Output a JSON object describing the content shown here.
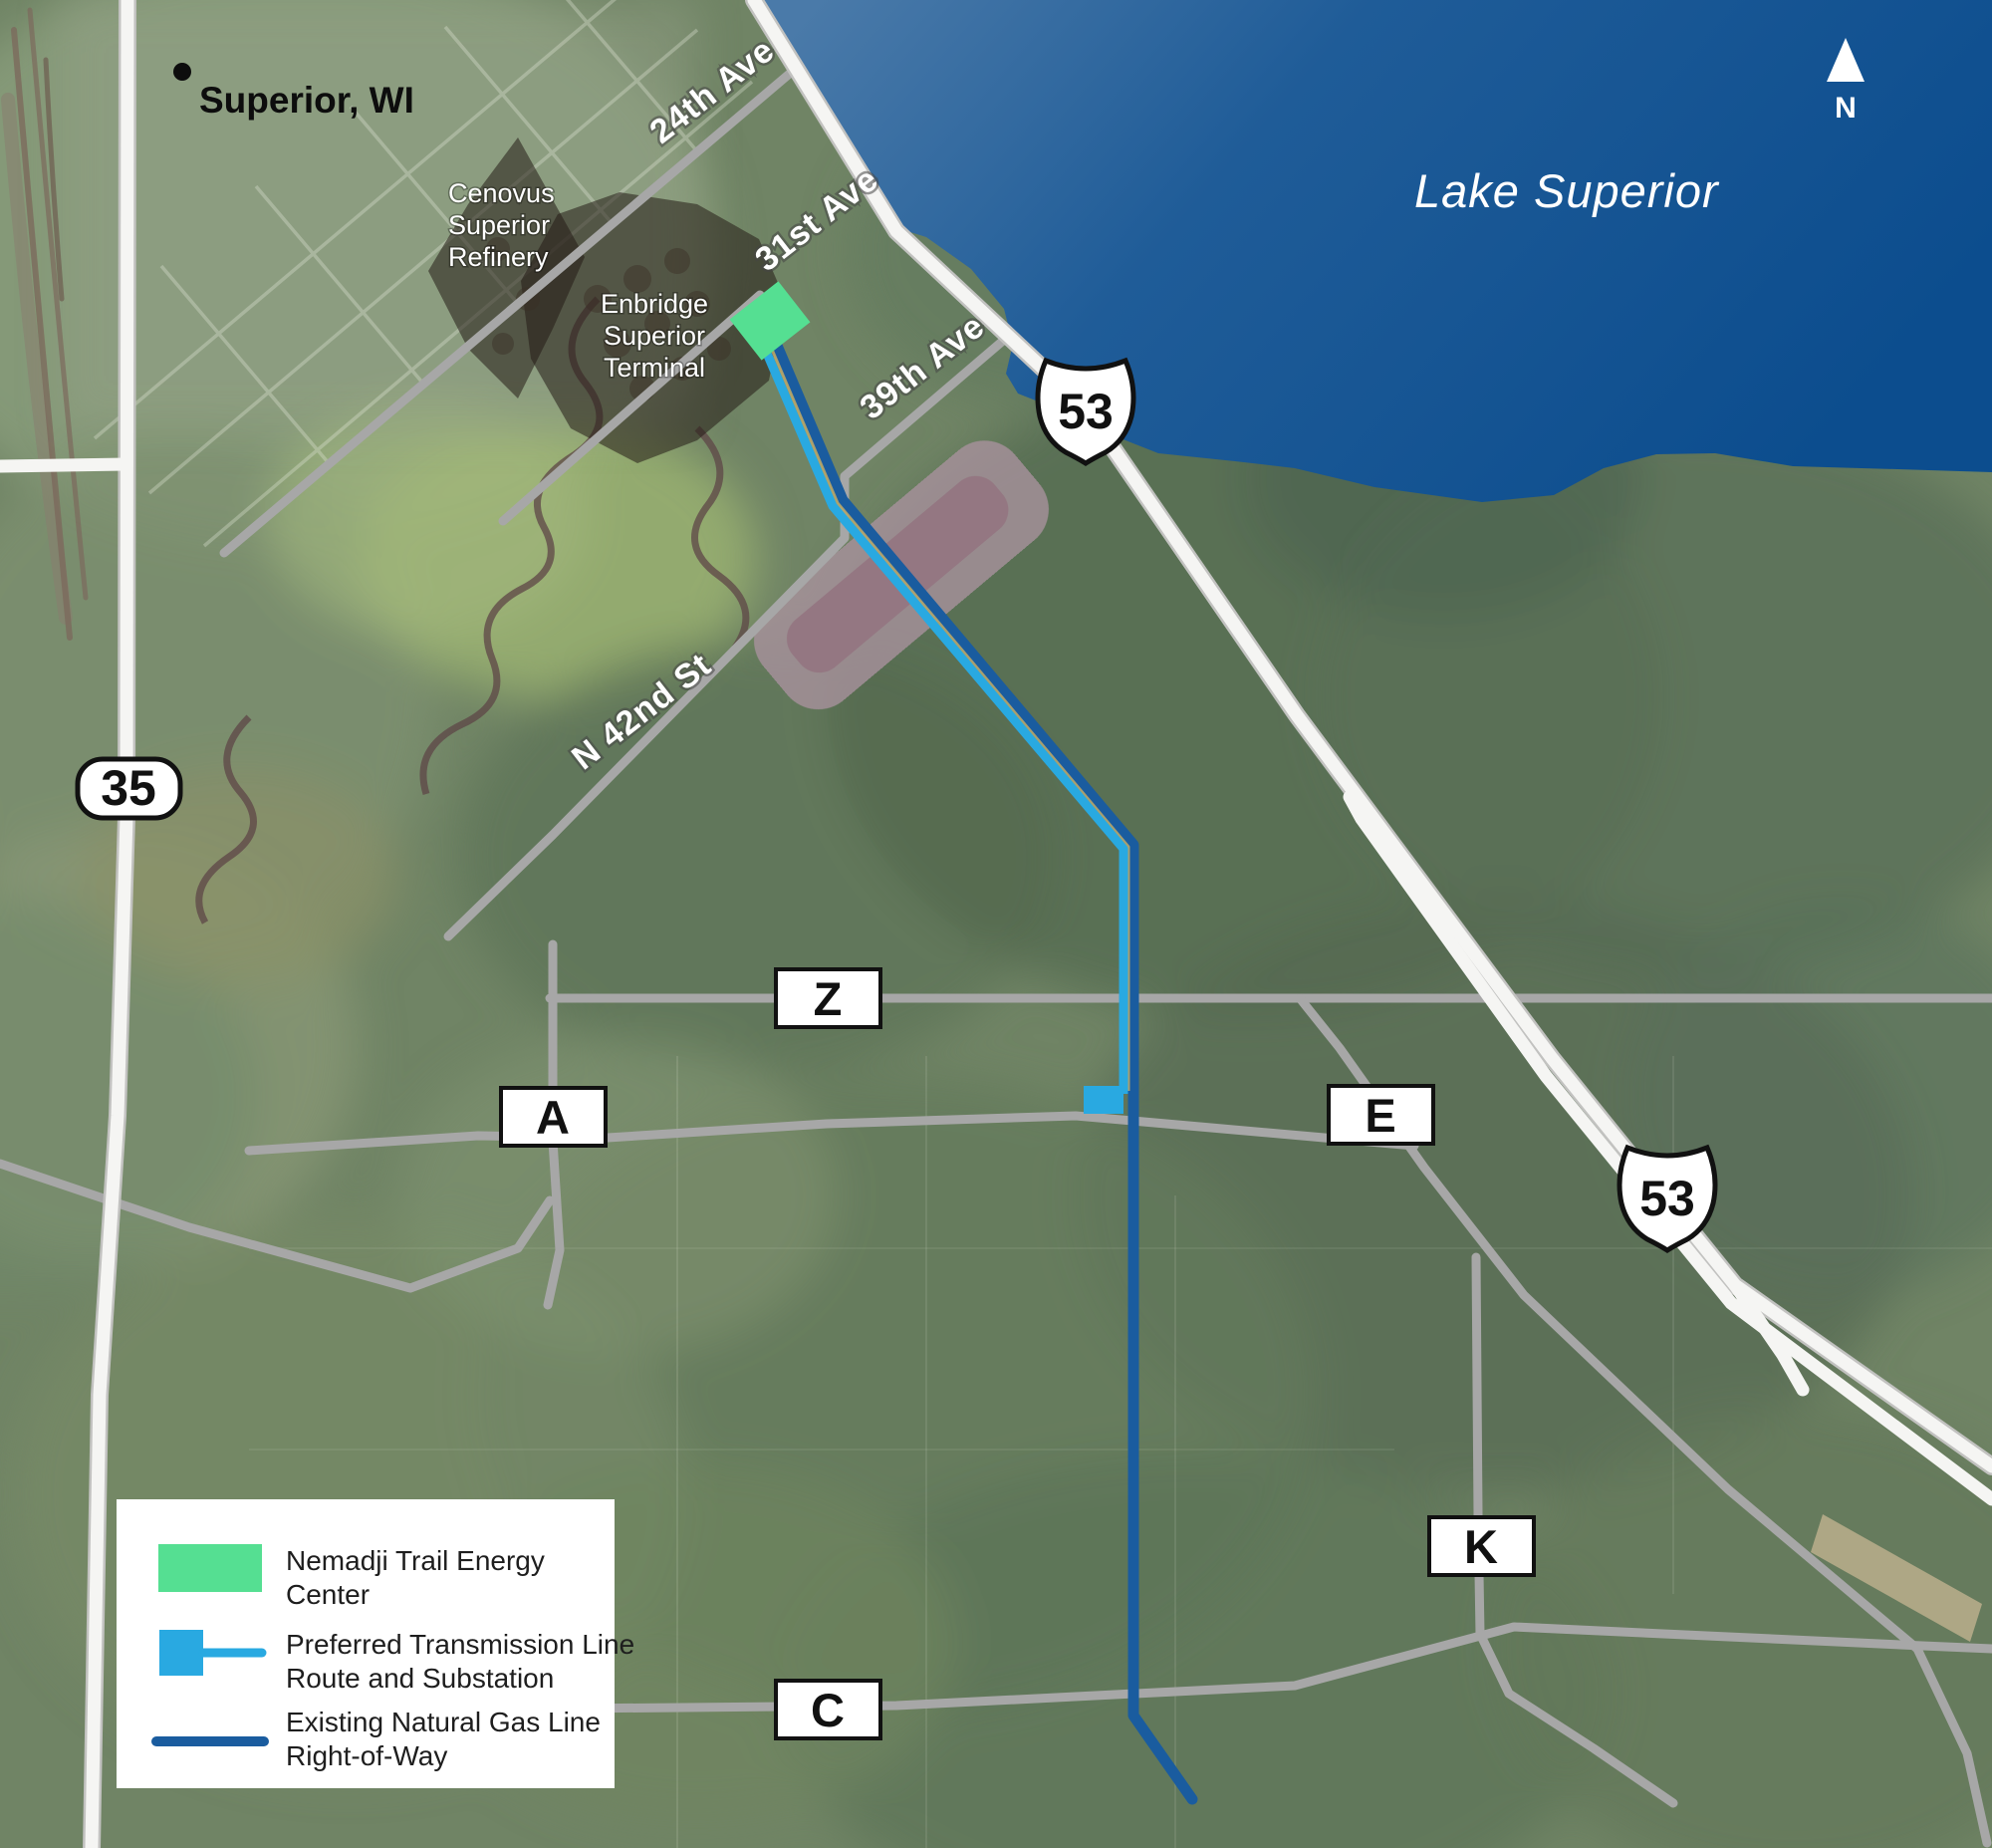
{
  "map": {
    "place_label": "Superior, WI",
    "lake_label": "Lake Superior",
    "north_label": "N",
    "streets": {
      "ave24": "24th Ave",
      "ave31": "31st Ave",
      "ave39": "39th Ave",
      "st42": "N 42nd St"
    },
    "highways": {
      "us53": "53",
      "wi35": "35"
    },
    "county_roads": {
      "z": "Z",
      "a": "A",
      "e": "E",
      "k": "K",
      "c": "C"
    },
    "areas": {
      "cenovus_l1": "Cenovus",
      "cenovus_l2": "Superior",
      "cenovus_l3": "Refinery",
      "enbridge_l1": "Enbridge",
      "enbridge_l2": "Superior",
      "enbridge_l3": "Terminal"
    }
  },
  "legend": {
    "items": [
      {
        "line1": "Nemadji Trail Energy",
        "line2": "Center"
      },
      {
        "line1": "Preferred Transmission Line",
        "line2": "Route and Substation"
      },
      {
        "line1": "Existing Natural Gas Line",
        "line2": "Right-of-Way"
      }
    ]
  },
  "colors": {
    "energy_green": "#55DF92",
    "transmission_blue": "#29A9E1",
    "gas_navy": "#1A5C9F"
  }
}
